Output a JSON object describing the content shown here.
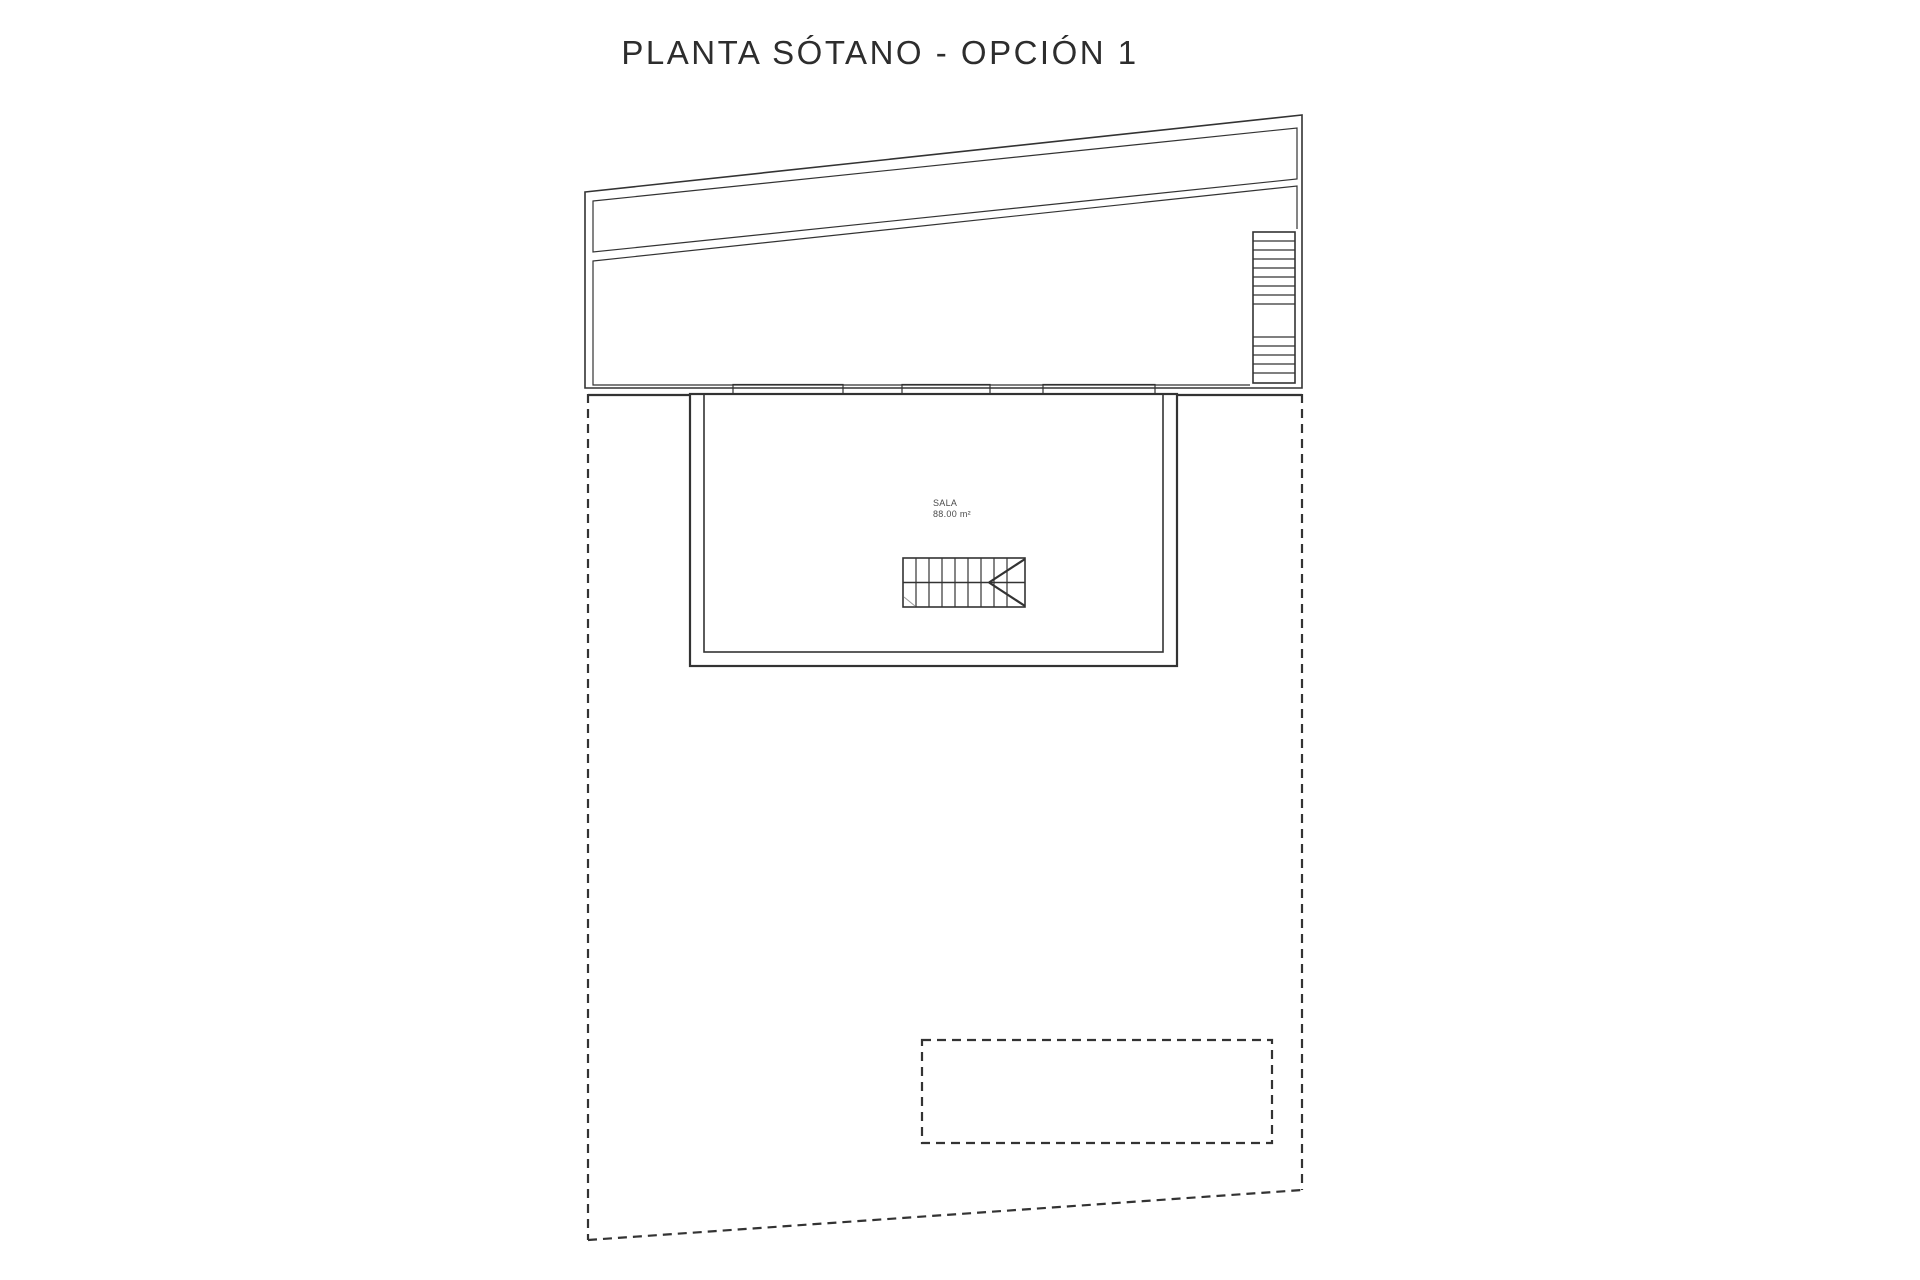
{
  "title": "PLANTA SÓTANO - OPCIÓN 1",
  "plan": {
    "room": {
      "name": "SALA",
      "area": "88.00 m²"
    }
  },
  "colors": {
    "terrain_band": "#A49D55",
    "grass": "#3AB80D",
    "window_fill": "#D8D8D8",
    "line": "#333333",
    "background": "#FFFFFF"
  }
}
